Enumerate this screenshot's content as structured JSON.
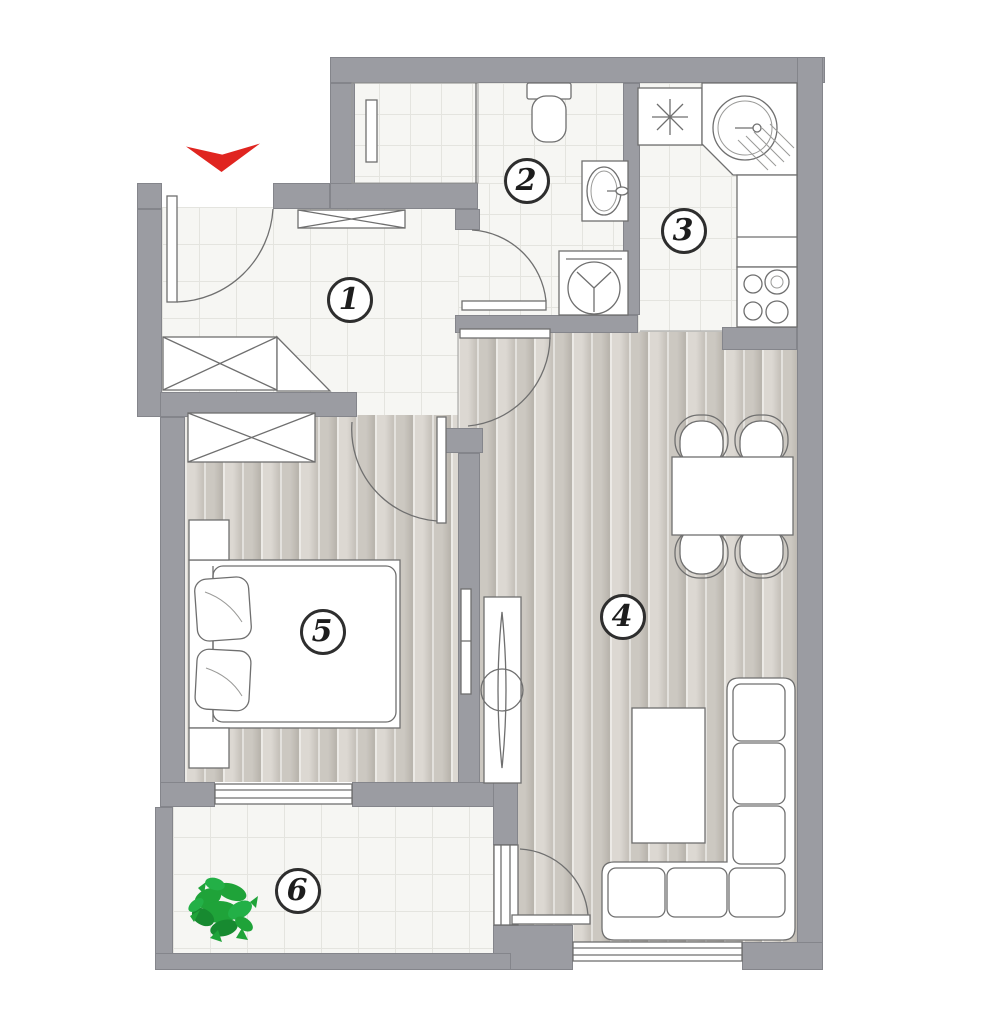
{
  "plan": {
    "rooms": [
      {
        "number": "1"
      },
      {
        "number": "2"
      },
      {
        "number": "3"
      },
      {
        "number": "4"
      },
      {
        "number": "5"
      },
      {
        "number": "6"
      }
    ],
    "entrance_marker": {
      "icon": "entrance-arrow",
      "color": "#e02520"
    },
    "colors": {
      "wall": "#9b9ca2",
      "tile_floor": "#f6f6f3",
      "wood_floor": "#d6d2cb",
      "accent_red": "#e02520",
      "plant_green": "#1fa339"
    }
  }
}
